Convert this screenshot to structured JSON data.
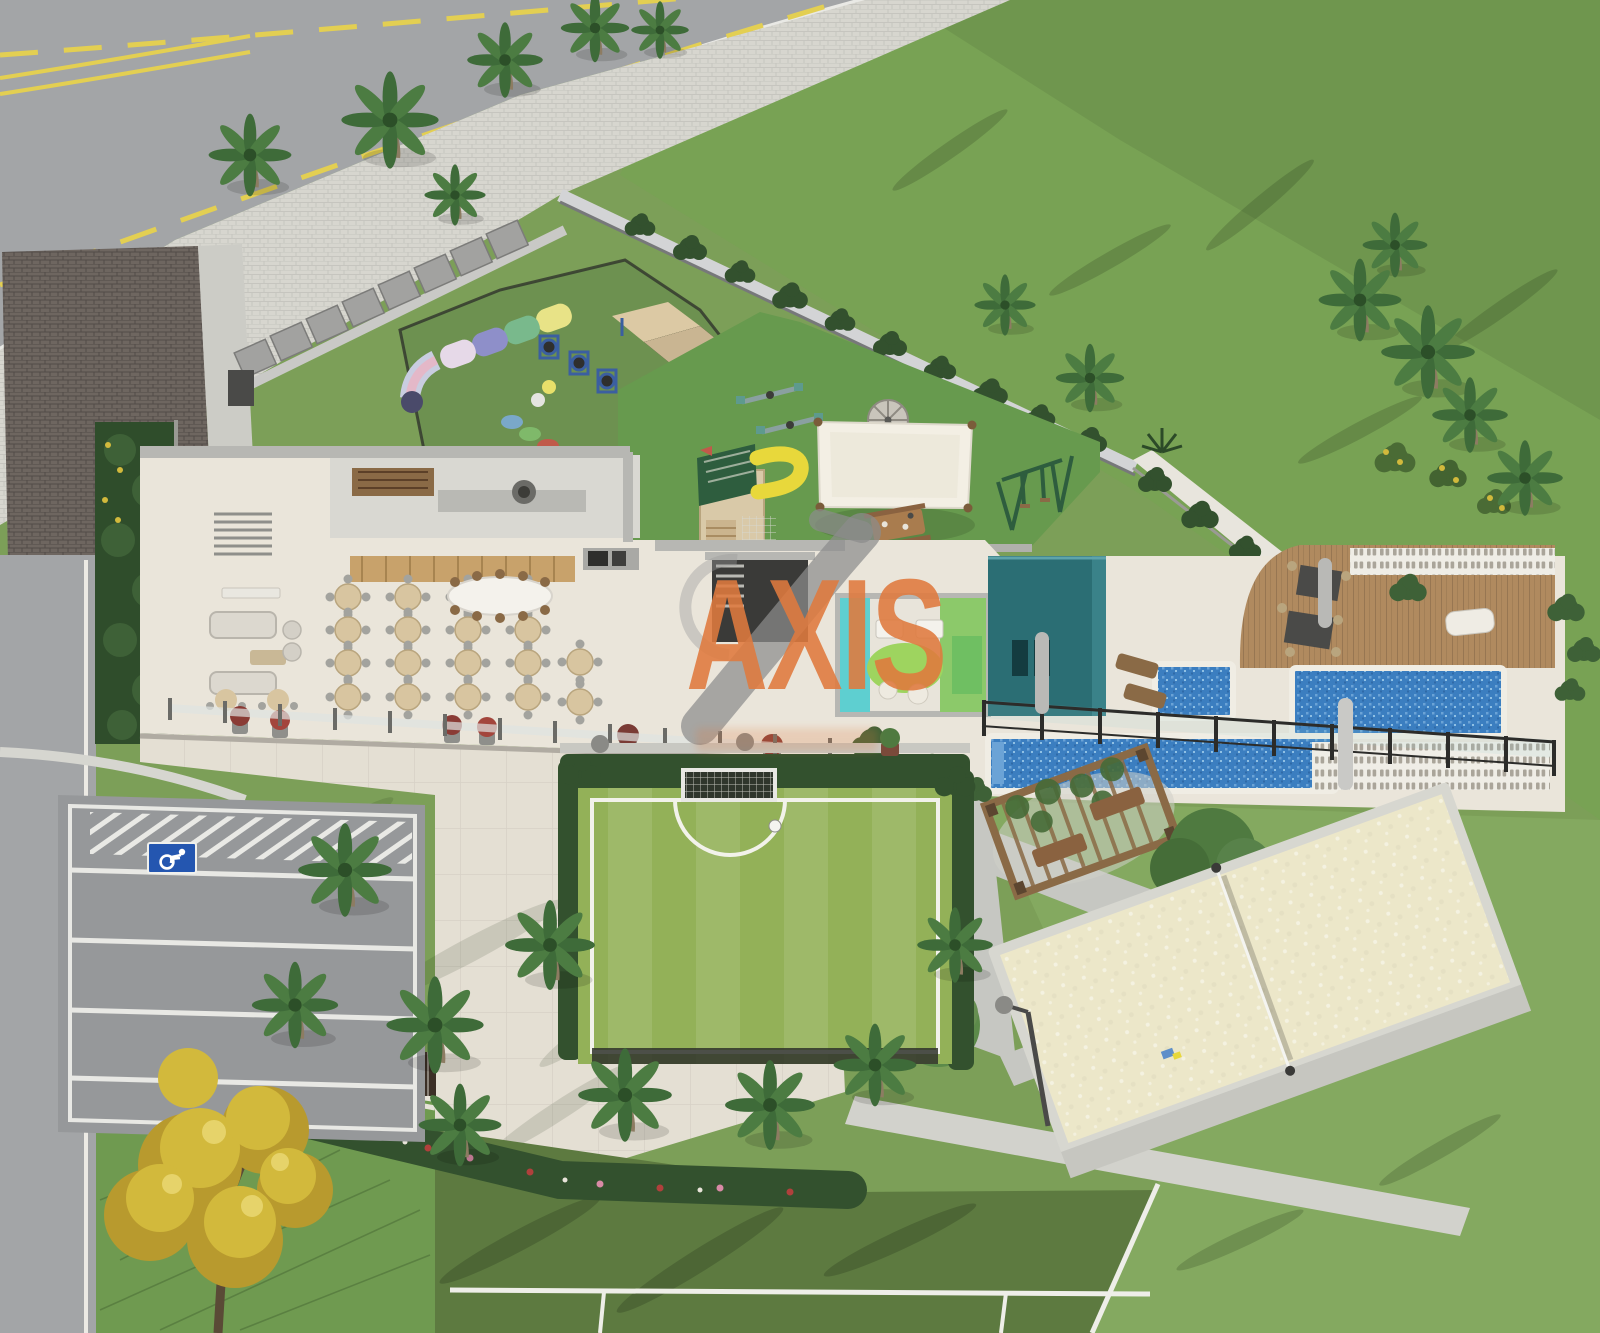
{
  "watermark": {
    "text": "AXIS",
    "color": "#e07a3e",
    "slash_color": "#8c8c8c"
  },
  "icons": [
    {
      "name": "wheelchair-icon",
      "meaning": "accessible parking space marking",
      "color": "#2456b0"
    }
  ],
  "palette": {
    "lawn": "#7c9f58",
    "lawn-rich": "#78a254",
    "lawn-light": "#84a960",
    "lawn-slope": "#6f9a50",
    "court-dark": "#5d7a40",
    "soccer": "#93b158",
    "turf": "#679a4e",
    "dogpark": "#6d9150",
    "asphalt": "#a3a5a7",
    "asphalt-dark": "#96989a",
    "paver": "#d7d6cf",
    "cream": "#eae5da",
    "plaza": "#e4dfd3",
    "wall": "#b7b7b3",
    "wall-light": "#d3d4d6",
    "white-wall": "#e8e5dd",
    "brick": "#6e6660",
    "wood": "#b08a5f",
    "wood-dark": "#8a6a46",
    "tan": "#d8c5a0",
    "water": "#3b7ec0",
    "water-light": "#6ba3d6",
    "sand": "#ece7c9",
    "teal": "#2b6e74",
    "cyan": "#5ecfd0",
    "lime": "#9ed45f",
    "kidgreen": "#6fbf62",
    "hedge": "#33512e",
    "palm1": "#3e6b39",
    "palm2": "#4c7c42",
    "canopy": "#4f7a40",
    "trunk": "#8d7c62",
    "yellow-line": "#e3cf52",
    "yellow-tree": "#d2b93c",
    "yellow-tree-dark": "#b89a2e",
    "flower-red": "#b0403c",
    "flower-pink": "#d98aa6",
    "roof-green": "#2e5d3e",
    "slide-yellow": "#e8d83b",
    "sail": "#f3efe4",
    "navy": "#3b5fa0",
    "handicap": "#2456b0",
    "dark-fence": "#2f332c",
    "steel": "#4a4a48"
  },
  "scene": {
    "description": "Aerial 3D architectural rendering of a residential condominium amenity deck surrounded by lawns, palms and streets",
    "regions": [
      {
        "name": "street-top-left",
        "color": "asphalt",
        "features": [
          "yellow-dashed-center-lines",
          "white-curb"
        ]
      },
      {
        "name": "paver-sidewalk",
        "color": "paver"
      },
      {
        "name": "entrance-building-roof",
        "color": "brick"
      },
      {
        "name": "service-lockers-row",
        "color": "wall"
      },
      {
        "name": "dog-park",
        "color": "dogpark",
        "features": [
          "color-tunnel",
          "a-frame-ramp",
          "tire-jumps",
          "stepping-discs",
          "balls",
          "perimeter-fence"
        ]
      },
      {
        "name": "playground",
        "color": "turf",
        "features": [
          "playhouse-with-yellow-slide",
          "shade-sail",
          "picnic-table",
          "seesaws",
          "merry-go-round",
          "swing-set"
        ]
      },
      {
        "name": "party-hall",
        "color": "cream",
        "features": [
          "round-banquet-tables",
          "oval-dining-table",
          "lounge-sofas",
          "bistro-tables",
          "kitchen-counters",
          "stairs"
        ]
      },
      {
        "name": "kids-playroom",
        "color": "cyan",
        "features": [
          "kids-tables",
          "bean-bags",
          "play-rug"
        ]
      },
      {
        "name": "pool-house",
        "color": "teal"
      },
      {
        "name": "kids-pool",
        "color": "water"
      },
      {
        "name": "main-pool",
        "color": "water"
      },
      {
        "name": "lap-pool",
        "color": "water"
      },
      {
        "name": "sun-deck",
        "color": "wood",
        "features": [
          "dining-tables",
          "sun-lounger",
          "cobogo-screen"
        ]
      },
      {
        "name": "glass-pool-fence",
        "color": "dark-fence"
      },
      {
        "name": "right-garden",
        "color": "hedge",
        "features": [
          "shrubs",
          "palm-cluster",
          "white-retaining-wall"
        ]
      },
      {
        "name": "pergola-lounge",
        "color": "wood-dark",
        "features": [
          "vine-roof",
          "wood-benches"
        ]
      },
      {
        "name": "sand-volleyball-court",
        "color": "sand",
        "features": [
          "net",
          "lamp-post"
        ]
      },
      {
        "name": "soccer-court",
        "color": "soccer",
        "features": [
          "white-markings",
          "goal-with-net",
          "ball",
          "hedge-border"
        ]
      },
      {
        "name": "central-plaza",
        "color": "plaza",
        "features": [
          "palm-shadows",
          "trellis"
        ]
      },
      {
        "name": "parking-lot",
        "color": "asphalt-dark",
        "features": [
          "white-stall-stripes",
          "hatched-zone",
          "accessible-space-sign"
        ]
      },
      {
        "name": "flower-hedge",
        "color": "hedge"
      },
      {
        "name": "tennis-court-partial",
        "color": "court-dark",
        "features": [
          "white-lines"
        ]
      },
      {
        "name": "access-road-left",
        "color": "asphalt"
      },
      {
        "name": "yellow-ipe-tree",
        "color": "yellow-tree"
      },
      {
        "name": "palm-trees",
        "color": "palm1"
      },
      {
        "name": "lawns",
        "color": "lawn"
      }
    ]
  }
}
